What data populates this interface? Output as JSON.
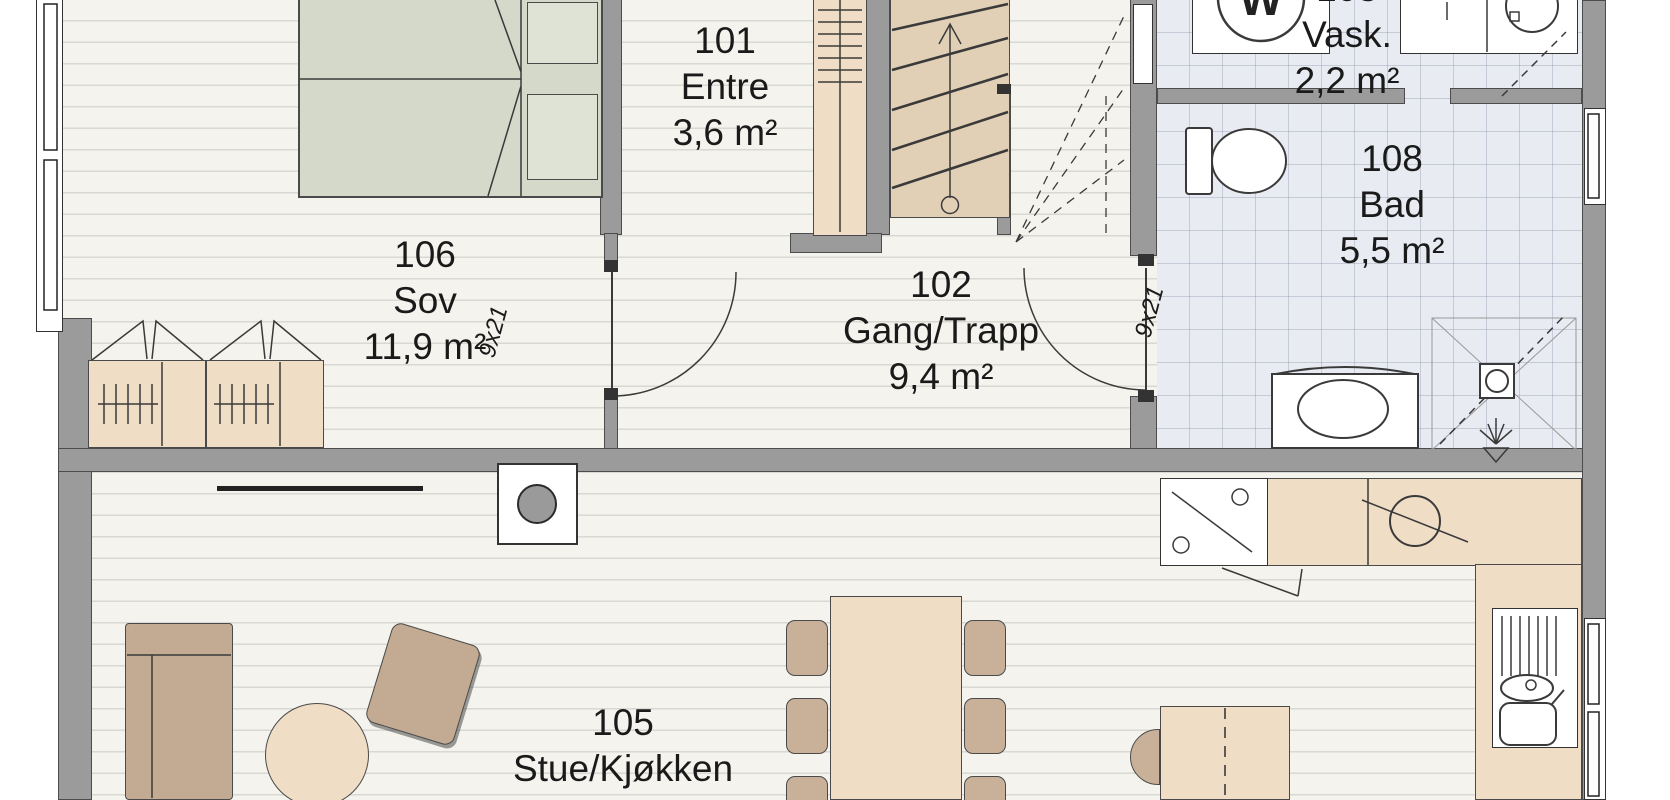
{
  "plan_title": "First floor plan",
  "rooms": {
    "sov": {
      "number": "106",
      "name": "Sov",
      "area": "11,9 m²"
    },
    "entre": {
      "number": "101",
      "name": "Entre",
      "area": "3,6 m²"
    },
    "gang": {
      "number": "102",
      "name": "Gang/Trapp",
      "area": "9,4 m²"
    },
    "vask": {
      "number": "103",
      "name": "Vask.",
      "area": "2,2 m²"
    },
    "bad": {
      "number": "108",
      "name": "Bad",
      "area": "5,5 m²"
    },
    "stue": {
      "number": "105",
      "name": "Stue/Kjøkken",
      "area": "34,6 m²"
    }
  },
  "doors": {
    "sov": "9x21",
    "bad": "9x21"
  },
  "appliances": {
    "washing_machine": "W"
  },
  "colors": {
    "wall": "#9b9b9b",
    "wood_floor": "#f4f3ee",
    "tile_floor": "#e9ebf2",
    "furniture": "#efddc5",
    "chair": "#c9b199",
    "upholstery": "#c3aa92",
    "bed": "#d5d9ca",
    "stair": "#e2d0b6"
  }
}
